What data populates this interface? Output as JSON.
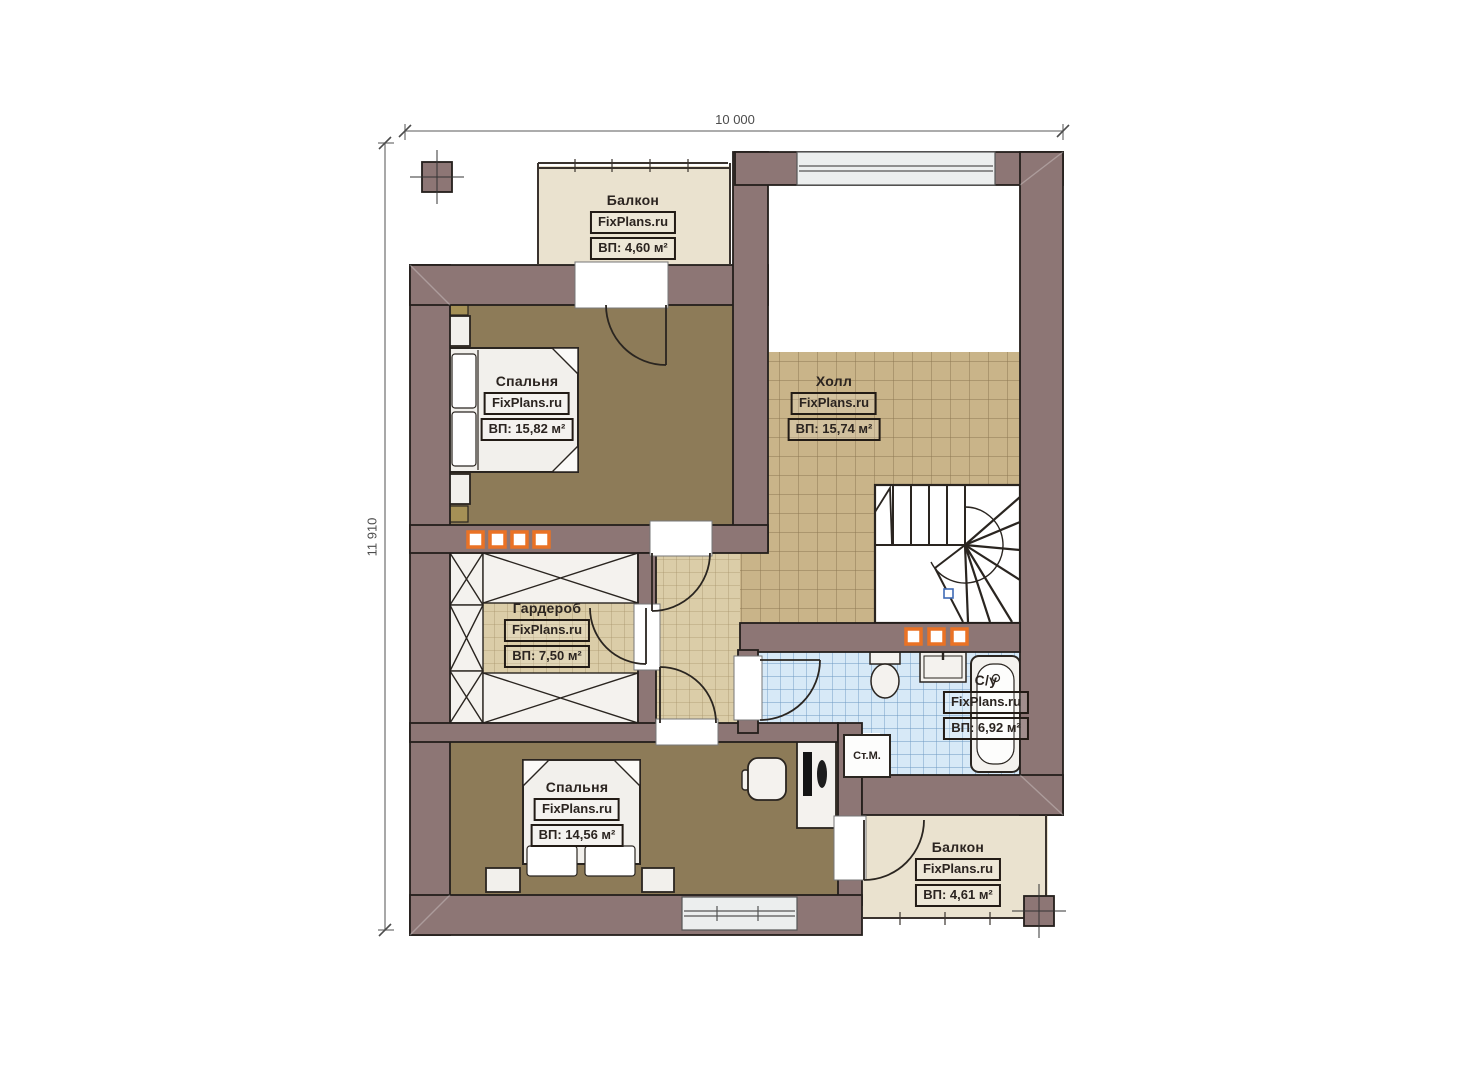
{
  "plan": {
    "watermark": "FixPlans.ru",
    "dimensions": {
      "width_mm": "10 000",
      "height_mm": "11 910"
    },
    "rooms": [
      {
        "id": "balcony-top",
        "name": "Балкон",
        "area": "ВП: 4,60 м²"
      },
      {
        "id": "bedroom-1",
        "name": "Спальня",
        "area": "ВП: 15,82 м²"
      },
      {
        "id": "hall",
        "name": "Холл",
        "area": "ВП: 15,74 м²"
      },
      {
        "id": "wardrobe",
        "name": "Гардероб",
        "area": "ВП: 7,50 м²"
      },
      {
        "id": "bathroom",
        "name": "С/у",
        "area": "ВП: 6,92 м²"
      },
      {
        "id": "bedroom-2",
        "name": "Спальня",
        "area": "ВП: 14,56 м²"
      },
      {
        "id": "balcony-bottom",
        "name": "Балкон",
        "area": "ВП: 4,61 м²"
      }
    ],
    "labels": {
      "washing_machine": "Ст.М."
    },
    "colors": {
      "wall": "#8d7675",
      "outline": "#241f1c",
      "bedroom_floor": "#8d7b58",
      "hall_tile": "#c9b489",
      "small_tile": "#dbcda8",
      "bath_tile": "#d7e9f7",
      "balcony_floor": "#eae2cf",
      "window_glass": "#eceeee",
      "radiator": "#ea7225"
    }
  }
}
